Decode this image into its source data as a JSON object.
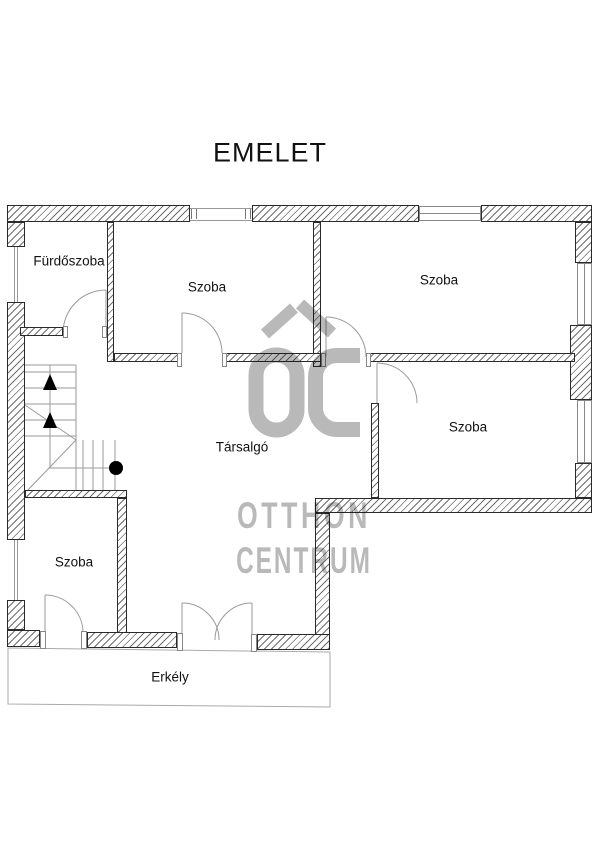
{
  "title": "EMELET",
  "rooms": {
    "bathroom": "Fürdőszoba",
    "room_top_left": "Szoba",
    "room_top_right": "Szoba",
    "room_mid_right": "Szoba",
    "room_bottom_left": "Szoba",
    "lounge": "Társalgó",
    "balcony": "Erkély"
  },
  "watermark": {
    "monogram": "OC",
    "line1": "OTTHON",
    "line2": "CENTRUM"
  },
  "colors": {
    "wall_line": "#2a2a2a",
    "hatch": "#6e6e6e",
    "thin_line": "#999999",
    "watermark": "#b9b9b9",
    "text": "#111111"
  }
}
